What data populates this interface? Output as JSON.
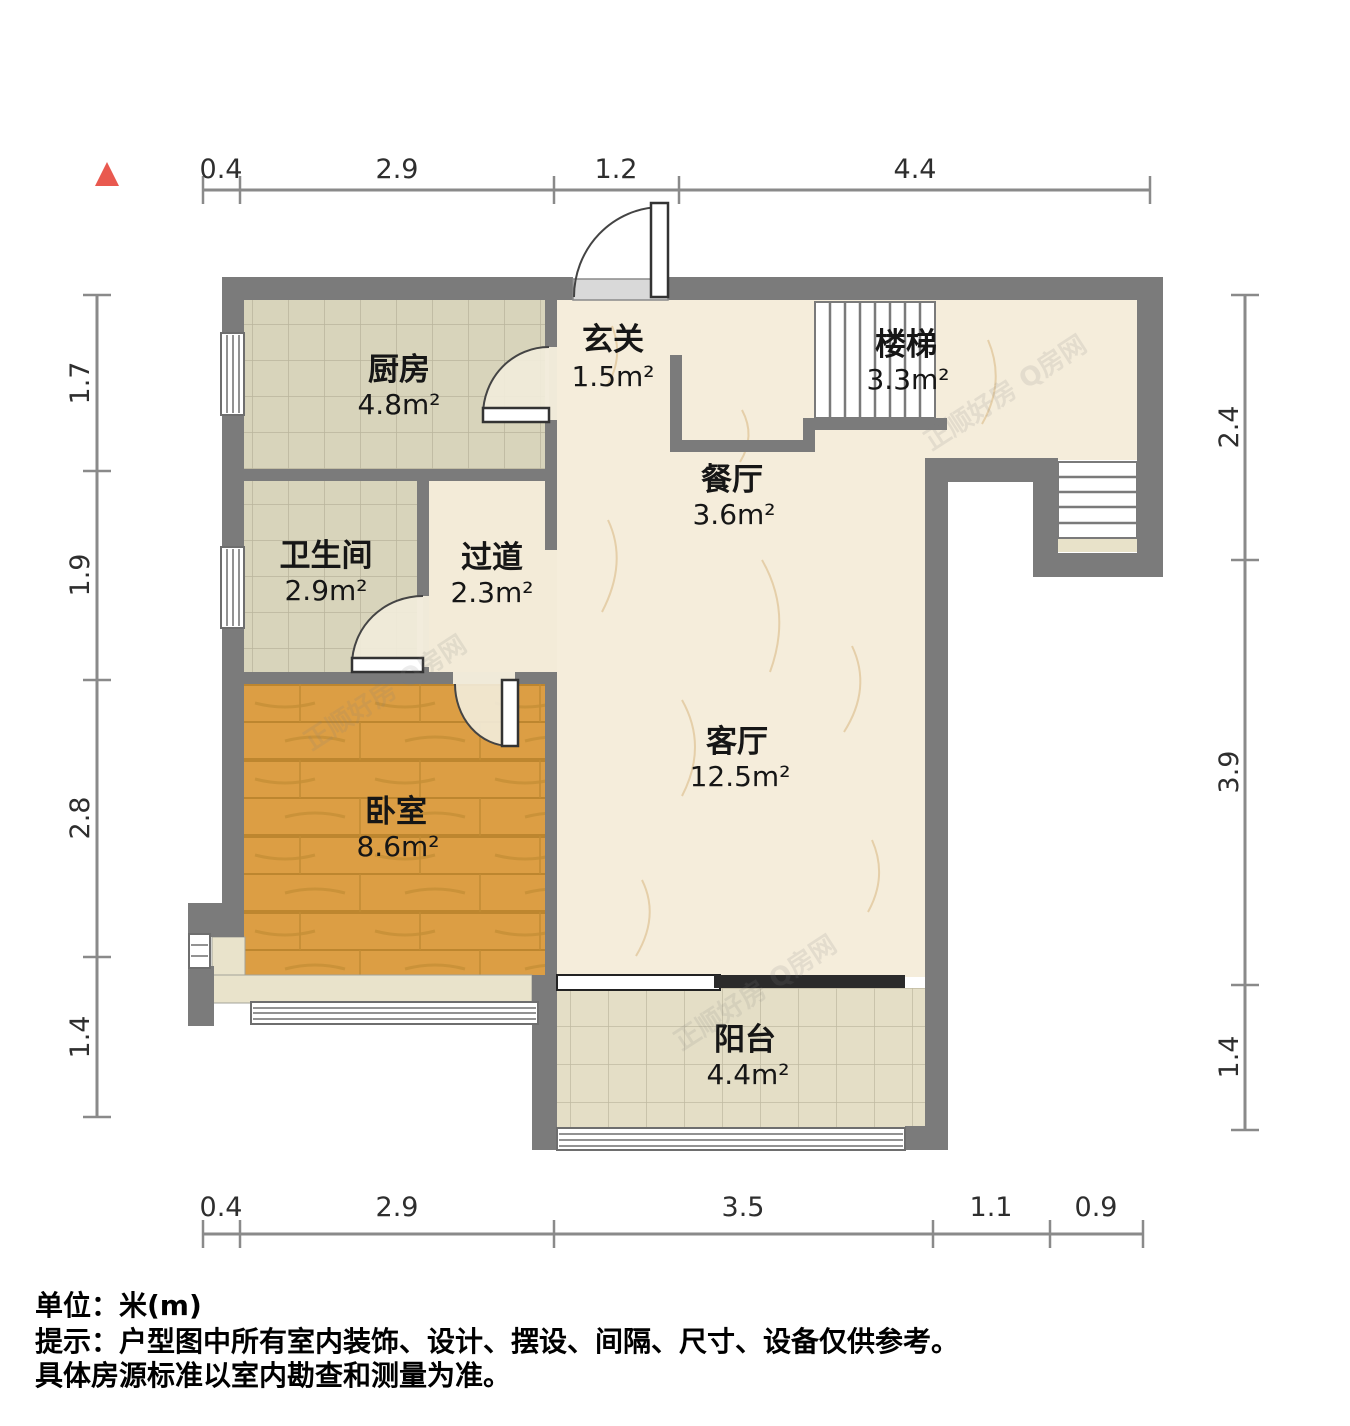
{
  "plan": {
    "rooms": {
      "kitchen": {
        "name": "厨房",
        "area": "4.8m²"
      },
      "entry": {
        "name": "玄关",
        "area": "1.5m²"
      },
      "stairs": {
        "name": "楼梯",
        "area": "3.3m²"
      },
      "dining": {
        "name": "餐厅",
        "area": "3.6m²"
      },
      "bathroom": {
        "name": "卫生间",
        "area": "2.9m²"
      },
      "hallway": {
        "name": "过道",
        "area": "2.3m²"
      },
      "living": {
        "name": "客厅",
        "area": "12.5m²"
      },
      "bedroom": {
        "name": "卧室",
        "area": "8.6m²"
      },
      "balcony": {
        "name": "阳台",
        "area": "4.4m²"
      }
    },
    "dims": {
      "top": [
        "0.4",
        "2.9",
        "1.2",
        "4.4"
      ],
      "left": [
        "1.7",
        "1.9",
        "2.8",
        "1.4"
      ],
      "right": [
        "2.4",
        "3.9",
        "1.4"
      ],
      "bottom": [
        "0.4",
        "2.9",
        "3.5",
        "1.1",
        "0.9"
      ]
    },
    "notes": {
      "unit": "单位：米(m)",
      "tip1": "提示：户型图中所有室内装饰、设计、摆设、间隔、尺寸、设备仅供参考。",
      "tip2": "具体房源标准以室内勘查和测量为准。"
    },
    "watermark": "正顺好房 Q房网",
    "colors": {
      "wall": "#7b7b7b",
      "marble_floor": "#f5eddb",
      "tile_floor": "#d8d4bb",
      "wood_floor": "#dc9e44",
      "balcony_floor": "#e4dec6",
      "north_arrow": "#e9594f"
    }
  }
}
